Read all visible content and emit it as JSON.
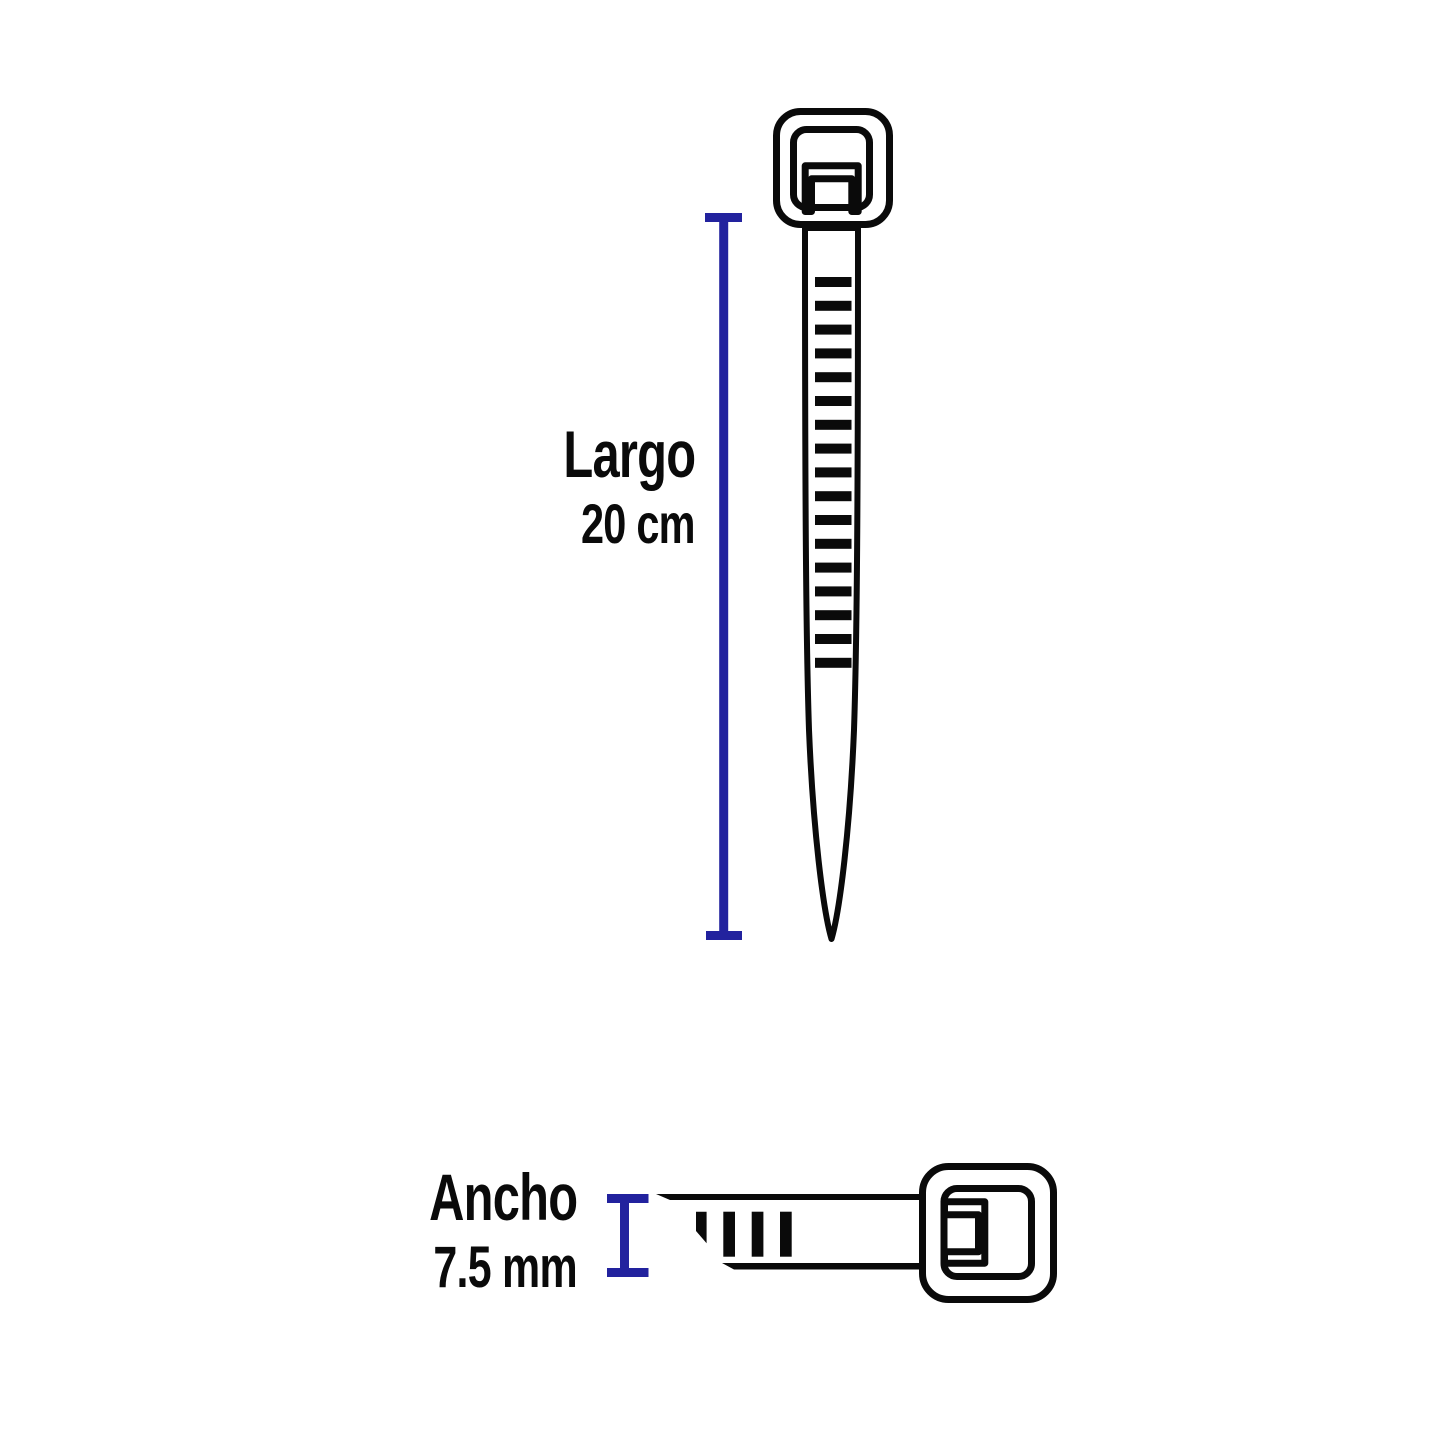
{
  "colors": {
    "accent": "#22229e",
    "ink": "#0a0a0a",
    "background": "#ffffff"
  },
  "figure": {
    "length_dimension": {
      "label": "Largo",
      "value": "20 cm"
    },
    "width_dimension": {
      "label": "Ancho",
      "value": "7.5 mm"
    }
  }
}
